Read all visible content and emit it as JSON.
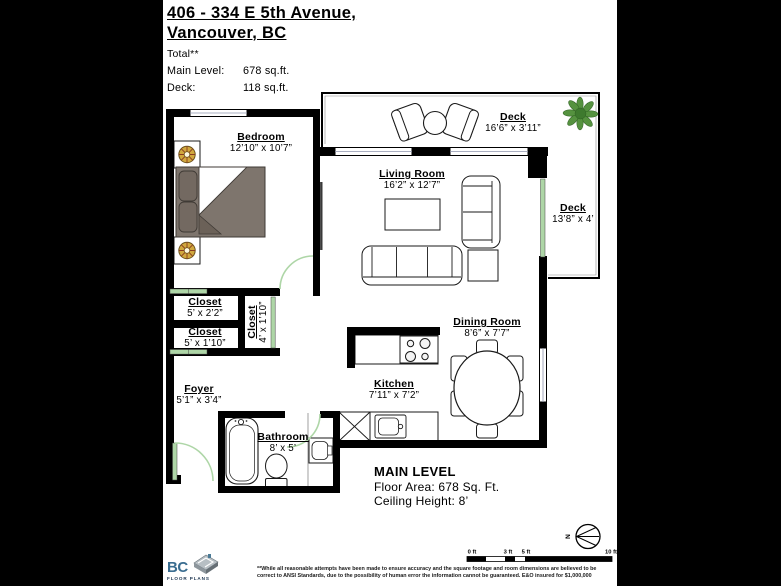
{
  "header": {
    "title_line1": "406 - 334 E 5th Avenue,",
    "title_line2": "Vancouver, BC",
    "total_label": "Total**",
    "areas": [
      {
        "label": "Main Level:",
        "value": "678 sq.ft."
      },
      {
        "label": "Deck:",
        "value": "118 sq.ft."
      }
    ]
  },
  "rooms": [
    {
      "id": "bedroom",
      "name": "Bedroom",
      "dims": "12’10” x 10’7”"
    },
    {
      "id": "deck-top",
      "name": "Deck",
      "dims": "16’6” x 3’11”"
    },
    {
      "id": "living-room",
      "name": "Living Room",
      "dims": "16’2” x 12’7”"
    },
    {
      "id": "deck-right",
      "name": "Deck",
      "dims": "13’8” x 4’"
    },
    {
      "id": "closet-1",
      "name": "Closet",
      "dims": "5’ x 2’2”"
    },
    {
      "id": "closet-2",
      "name": "Closet",
      "dims": "5’ x 1’10”"
    },
    {
      "id": "closet-3",
      "name": "Closet",
      "dims": "4’ x 1’10”"
    },
    {
      "id": "foyer",
      "name": "Foyer",
      "dims": "5’1” x 3’4”"
    },
    {
      "id": "kitchen",
      "name": "Kitchen",
      "dims": "7’11” x 7’2”"
    },
    {
      "id": "dining-room",
      "name": "Dining Room",
      "dims": "8’6” x 7’7”"
    },
    {
      "id": "bathroom",
      "name": "Bathroom",
      "dims": "8’ x 5’"
    }
  ],
  "footer": {
    "level_title": "MAIN LEVEL",
    "floor_area": "Floor Area: 678 Sq. Ft.",
    "ceiling_height": "Ceiling Height: 8’"
  },
  "scale": {
    "labels": [
      "0 ft",
      "3 ft",
      "5 ft",
      "10 ft"
    ]
  },
  "compass": {
    "label": "N"
  },
  "logo": {
    "brand": "BC",
    "subtitle": "FLOOR PLANS"
  },
  "disclaimer": {
    "text": "**While all reasonable attempts have been made to ensure accuracy and the square footage and room dimensions are believed to be correct to ANSI Standards, due to the possibility of human error the information cannot be guaranteed. E&O insured for $1,000,000"
  },
  "colors": {
    "wall": "#000000",
    "door_green": "#aed6a7",
    "bed_gray": "#7e756d",
    "lamp_gold": "#d1a83e",
    "plant_green": "#55923f",
    "logo_blue": "#3a6d90"
  }
}
